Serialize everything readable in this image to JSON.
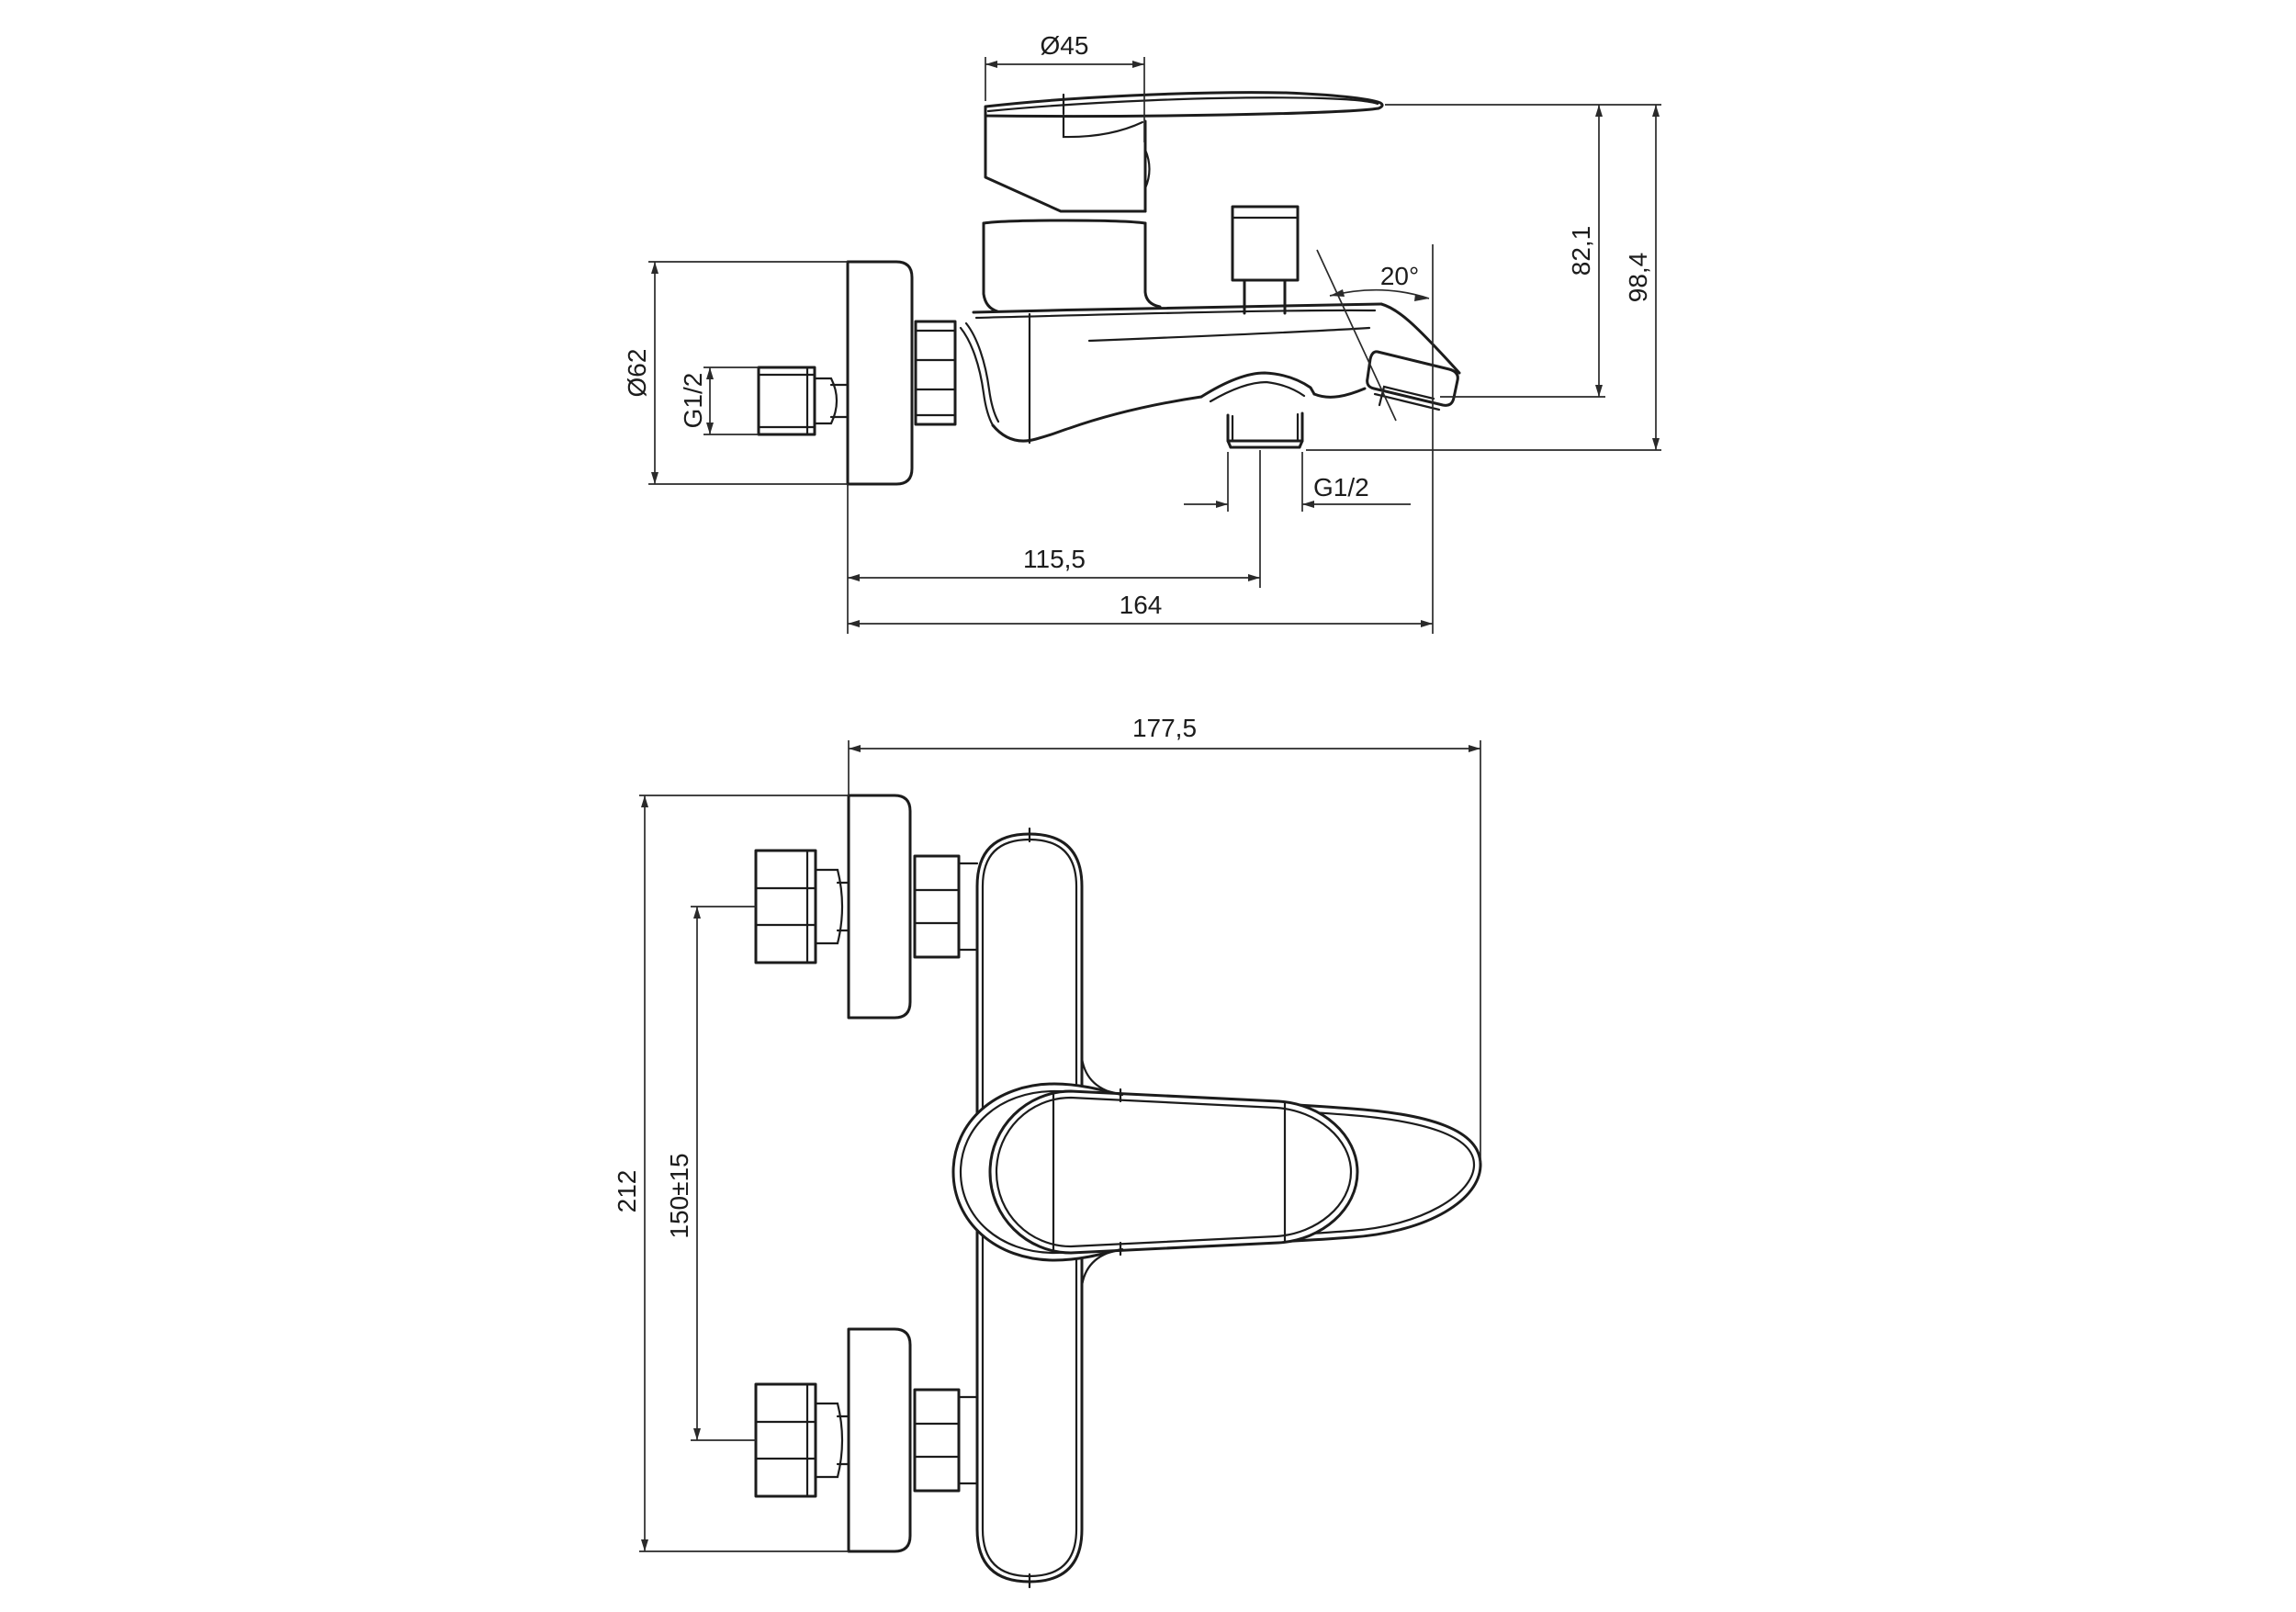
{
  "drawing": {
    "type": "technical-drawing",
    "subject": "wall-mounted bath mixer faucet, two orthographic views",
    "background_color": "#ffffff",
    "line_color": "#1c1c1c",
    "side_view": {
      "dims": {
        "handle_diameter": "Ø45",
        "spout_height": "82,1",
        "total_height": "98,4",
        "escutcheon_diameter": "Ø62",
        "wall_thread": "G1/2",
        "spout_angle": "20°",
        "outlet_offset": "115,5",
        "total_projection": "164",
        "outlet_thread": "G1/2"
      }
    },
    "front_view": {
      "dims": {
        "total_width": "177,5",
        "total_height": "212",
        "inlet_spacing": "150±15"
      }
    }
  }
}
